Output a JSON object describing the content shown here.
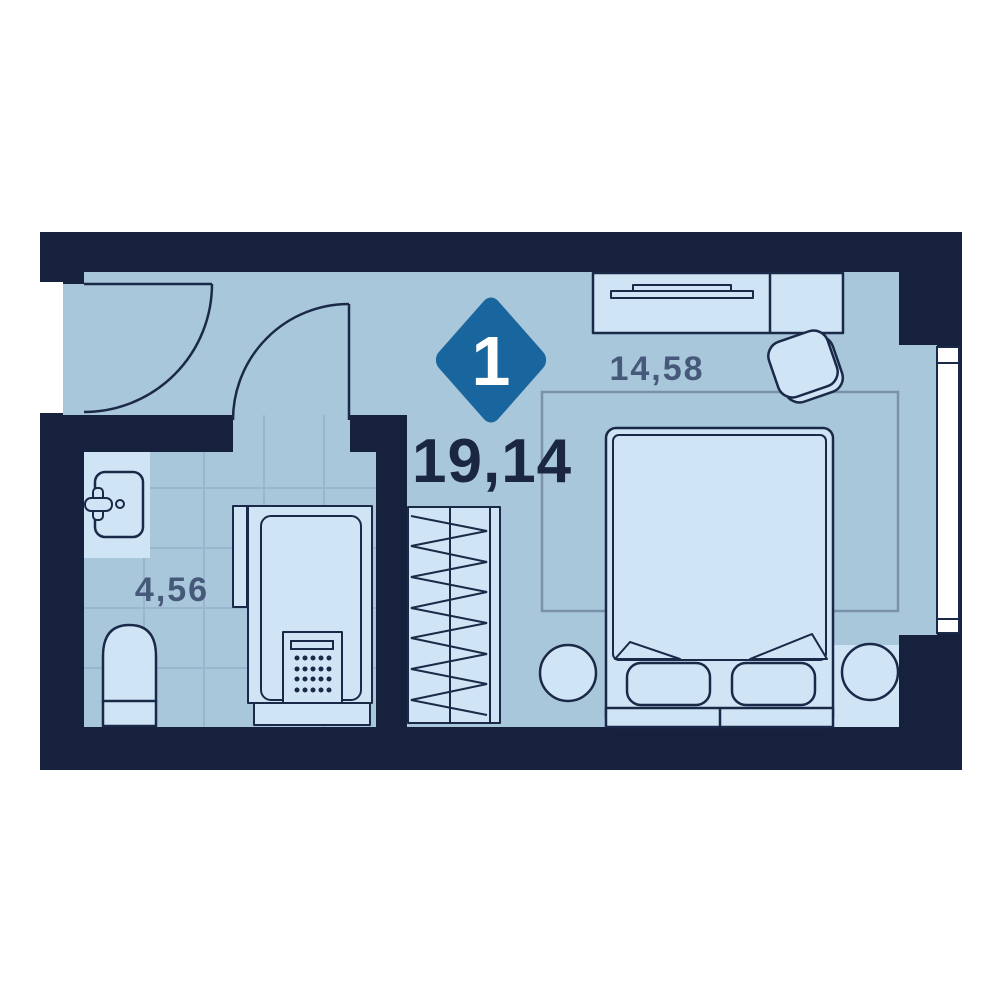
{
  "floorplan": {
    "badge": {
      "rooms_count": "1"
    },
    "total_area_label": "19,14",
    "rooms": [
      {
        "id": "bedroom",
        "area_label": "14,58"
      },
      {
        "id": "bathroom",
        "area_label": "4,56"
      }
    ]
  },
  "colors": {
    "wall": "#16213e",
    "floor": "#a9c7db",
    "furniture": "#cfe5f5",
    "line": "#1b2948",
    "tile-line": "#98b7ce",
    "badge-bg": "#19669f",
    "badge-text": "#ffffff",
    "total-ink": "#1b2742",
    "room-ink": "#47597a",
    "rug-line": "#7b90a9",
    "page-bg": "#ffffff"
  }
}
